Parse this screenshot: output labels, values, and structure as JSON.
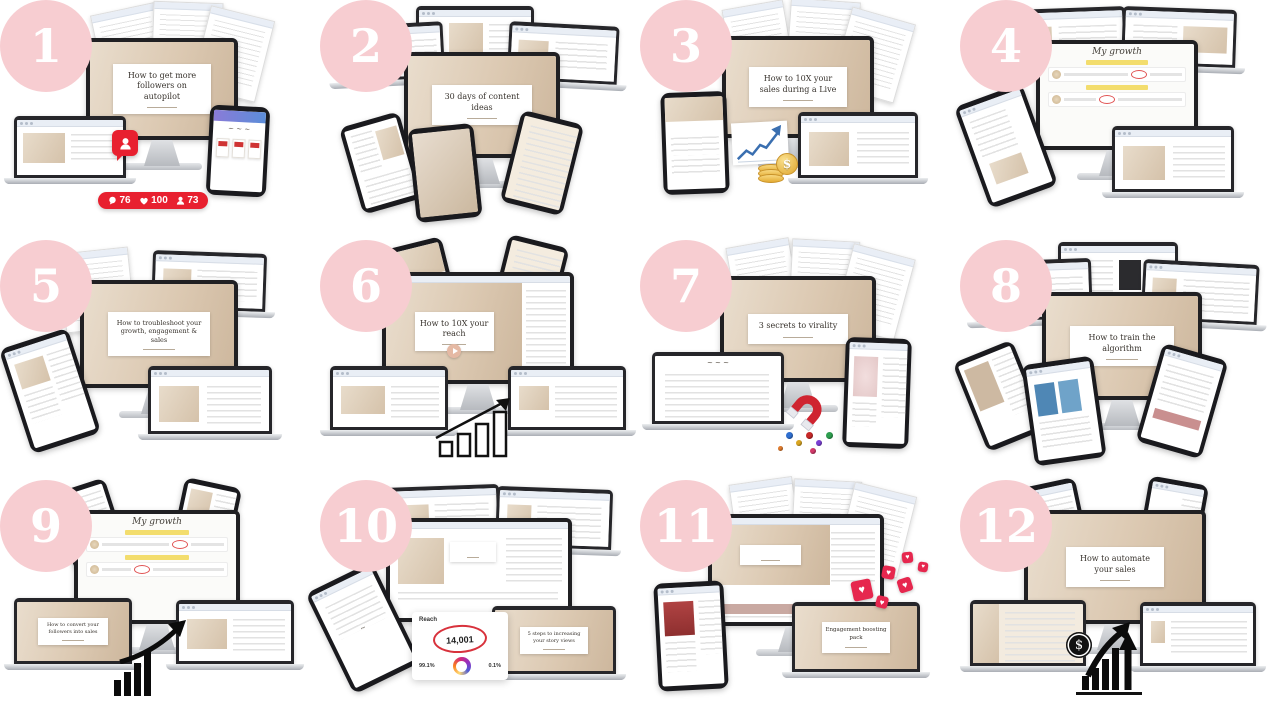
{
  "page": {
    "background": "#ffffff",
    "description": "12 course modules device-mockup grid"
  },
  "colors": {
    "badge_pink": "#f7cdd1",
    "accent_red": "#e8202f",
    "coin_gold": "#e3ab33",
    "beige": "#dcc9b2",
    "chart_blue": "#3a6fb0"
  },
  "icons": {
    "heart_glyph": "♥"
  },
  "modules": [
    {
      "number": "1",
      "title": "How to get more followers on autopilot",
      "stats": {
        "comments": "76",
        "likes": "100",
        "follows": "73"
      }
    },
    {
      "number": "2",
      "title": "30 days of content ideas"
    },
    {
      "number": "3",
      "title": "How to 10X your sales during a Live",
      "tablet_heading": "Frameworks",
      "coin_symbol": "$"
    },
    {
      "number": "4",
      "whiteboard_title": "My growth"
    },
    {
      "number": "5",
      "title": "How to troubleshoot your growth, engagement & sales"
    },
    {
      "number": "6",
      "title": "How to 10X your reach"
    },
    {
      "number": "7",
      "title": "3 secrets to virality"
    },
    {
      "number": "8",
      "title": "How to train the algorithm"
    },
    {
      "number": "9",
      "whiteboard_title": "My growth",
      "laptop_title": "How to convert your followers into sales"
    },
    {
      "number": "10",
      "laptop_title": "5 steps to increasing your story views",
      "analytics": {
        "label": "Reach",
        "value": "14,001",
        "left_pct": "99.1%",
        "right_pct": "0.1%"
      }
    },
    {
      "number": "11",
      "laptop_title": "Engagement boosting pack"
    },
    {
      "number": "12",
      "title": "How to automate your sales",
      "coin_symbol": "$"
    }
  ]
}
